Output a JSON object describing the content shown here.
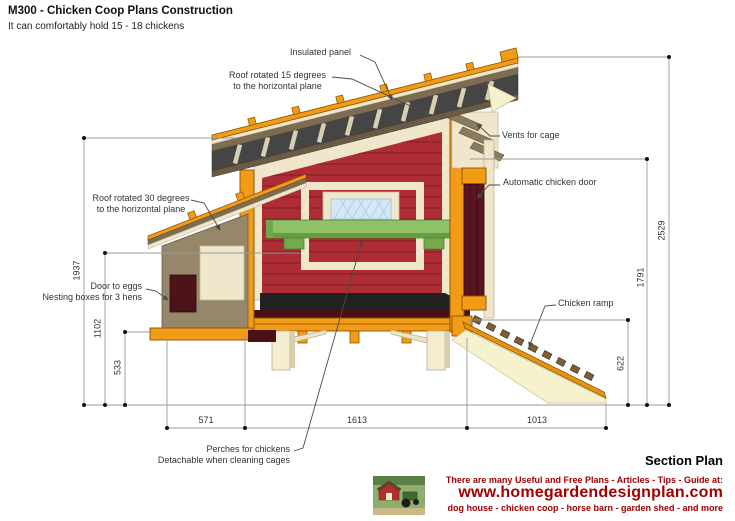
{
  "header": {
    "title": "M300 - Chicken Coop Plans Construction",
    "subtitle": "It can comfortably hold 15 - 18 chickens"
  },
  "annotations": {
    "insulated_panel": "Insulated panel",
    "roof15_line1": "Roof rotated 15 degrees",
    "roof15_line2": "to the horizontal plane",
    "vents": "Vents for cage",
    "auto_door": "Automatic chicken door",
    "roof30_line1": "Roof rotated 30 degrees",
    "roof30_line2": "to the horizontal plane",
    "door_to_eggs": "Door to eggs",
    "nesting_boxes": "Nesting boxes for 3 hens",
    "chicken_ramp": "Chicken ramp",
    "perches_line1": "Perches for chickens",
    "perches_line2": "Detachable when cleaning cages"
  },
  "dimensions": {
    "left_total": "1937",
    "left_mid": "1102",
    "left_lower": "533",
    "right_total": "2529",
    "right_mid": "1791",
    "right_lower": "622",
    "bottom_left": "571",
    "bottom_mid": "1613",
    "bottom_right": "1013"
  },
  "footer": {
    "section_title": "Section Plan",
    "promo_line1": "There are many Useful and Free Plans - Articles - Tips - Guide at:",
    "website": "www.homegardendesignplan.com",
    "promo_line2": "dog house - chicken coop - horse barn - garden shed - and more"
  },
  "colors": {
    "accent_orange": "#F29B17",
    "wall_red": "#AE2C34",
    "perch_green": "#8FC168",
    "window_blue": "#D4E7F5",
    "brand_red": "#A00000",
    "dim_line_gray": "#9A9A9A"
  }
}
